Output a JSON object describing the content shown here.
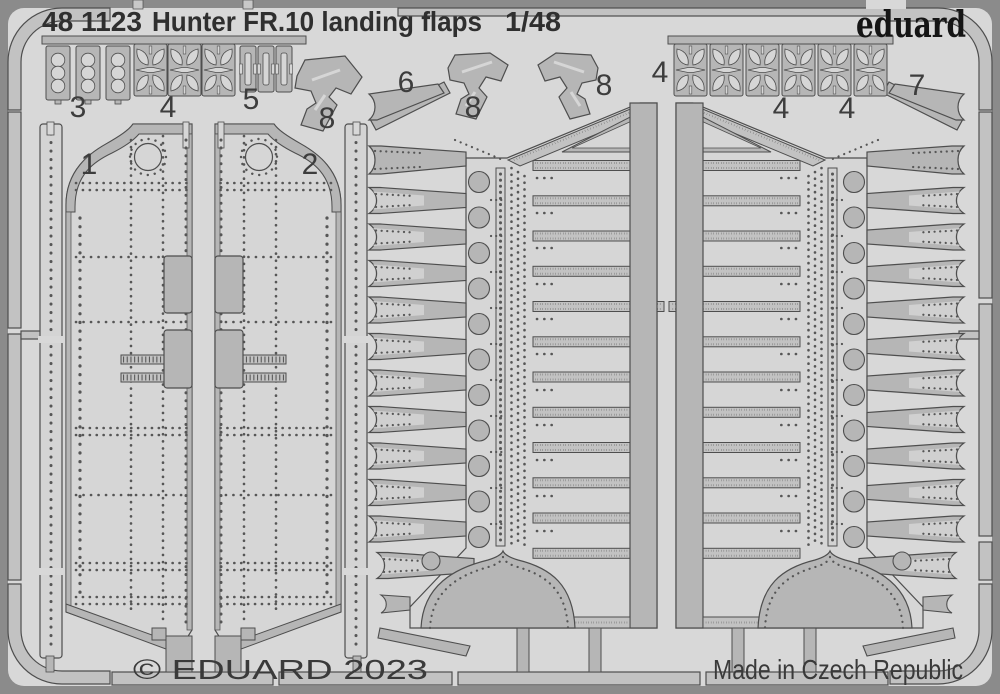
{
  "header": {
    "product_code": "48 1123",
    "product_name": "Hunter FR.10 landing flaps",
    "scale": "1/48",
    "brand": "eduard"
  },
  "footer": {
    "copyright": "© EDUARD 2023",
    "made_in": "Made in Czech Republic"
  },
  "part_labels": [
    "1",
    "2",
    "3",
    "4",
    "5",
    "8",
    "6",
    "8",
    "8",
    "4",
    "4",
    "4",
    "7"
  ],
  "colors": {
    "photo_background": "#8b8b8b",
    "sheet": "#d8d8d8",
    "metal": "#b6b6b6",
    "etched_light": "#d6d6d6",
    "outline": "#4e4e4e",
    "title_text": "#2f2f2f",
    "brand_text": "#151515"
  }
}
